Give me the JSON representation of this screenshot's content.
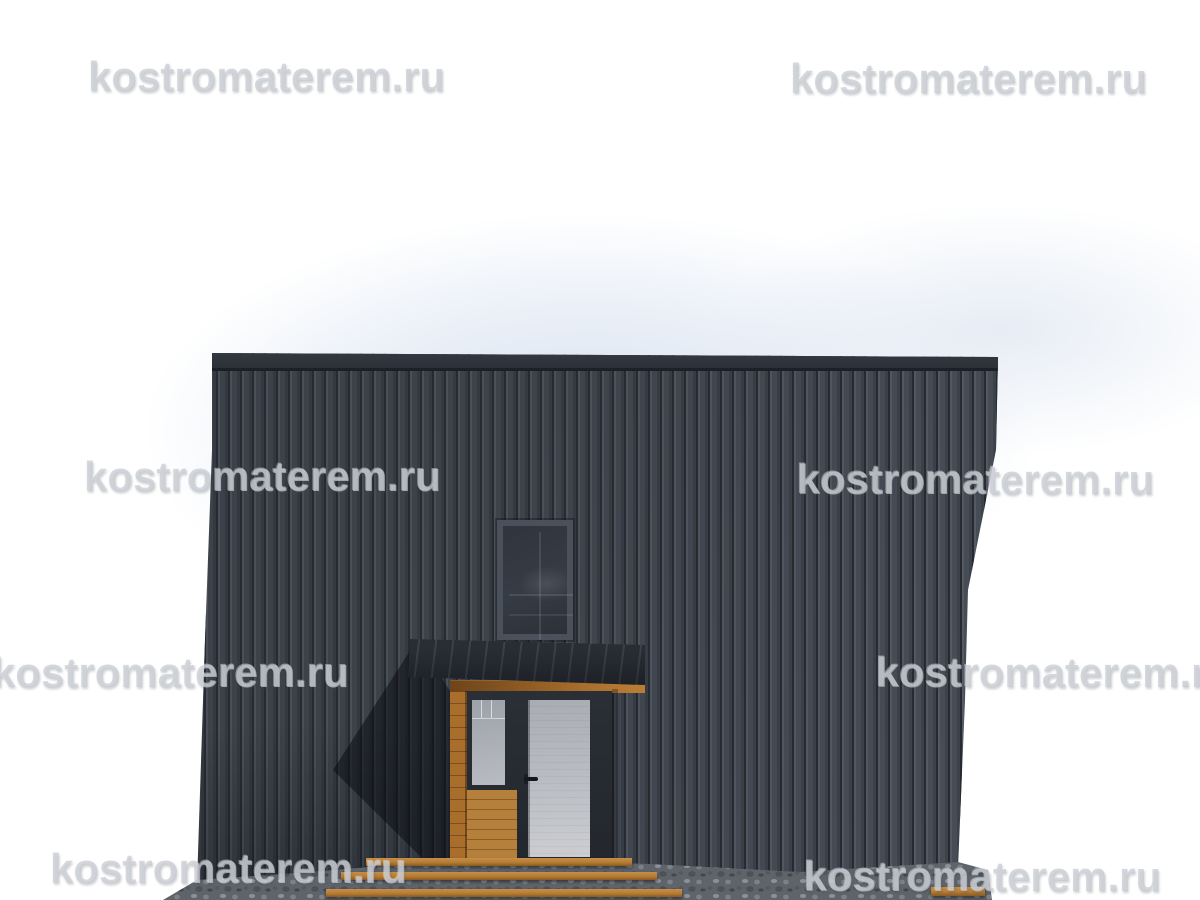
{
  "watermark": {
    "text": "kostromaterem.ru"
  },
  "colors": {
    "wall": "#3b4048",
    "wall_fascia": "#2c3138",
    "awning": "#2b3038",
    "wood": "#ad7230",
    "door": "#a9acb3",
    "entry_glass": "#a9adb4",
    "upper_window_glass": "#30353d",
    "stone": "#5f646b",
    "background": "#ffffff",
    "watermark_gray": "#c6cad1"
  }
}
